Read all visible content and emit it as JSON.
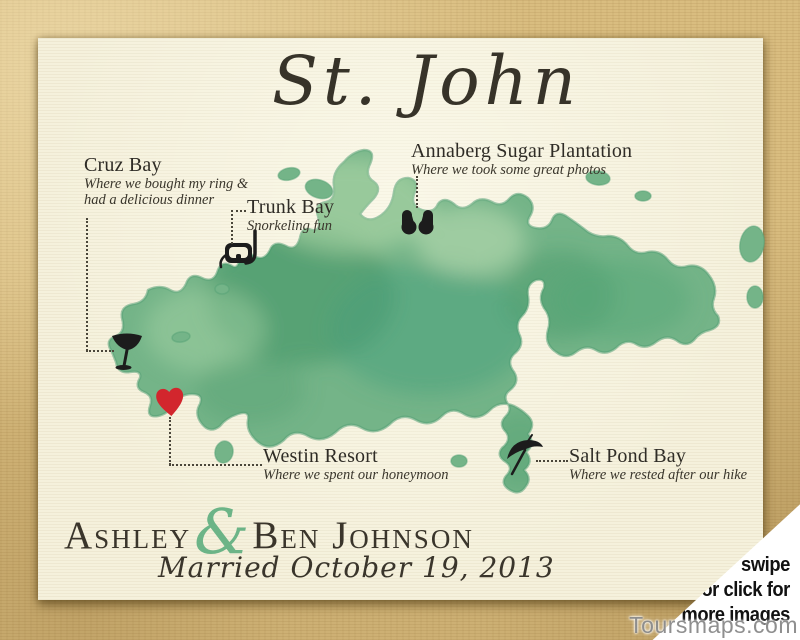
{
  "title": "St. John",
  "locations": [
    {
      "name": "Cruz Bay",
      "note1": "Where we bought my ring &",
      "note2": "had a delicious dinner",
      "icon": "martini-glass"
    },
    {
      "name": "Trunk Bay",
      "note1": "Snorkeling fun",
      "icon": "snorkel-mask"
    },
    {
      "name": "Annaberg Sugar Plantation",
      "note1": "Where we took some great photos",
      "icon": "binoculars"
    },
    {
      "name": "Westin Resort",
      "note1": "Where we spent our honeymoon",
      "icon": "heart"
    },
    {
      "name": "Salt Pond Bay",
      "note1": "Where we rested after our hike",
      "icon": "beach-umbrella"
    }
  ],
  "couple": {
    "first_name": "Ashley",
    "ampersand": "&",
    "partner_name": "Ben Johnson",
    "caption": "Married October 19, 2013"
  },
  "carousel_overlay": {
    "line1": "swipe",
    "line2": "or click for",
    "line3": "more images"
  },
  "watermark": "Toursmaps.com",
  "colors": {
    "background_tan": "#d9bd80",
    "paper_cream": "#f5f1dc",
    "island_green": "#74b488",
    "island_dark": "#3f9465",
    "island_light": "#b7daab",
    "heart_red": "#d2262d",
    "ampersand_green": "#6cb487",
    "ink_dark": "#3a352b",
    "leader_gray": "#4a463a",
    "overlay_white": "#ffffff",
    "overlay_text": "#111111"
  }
}
